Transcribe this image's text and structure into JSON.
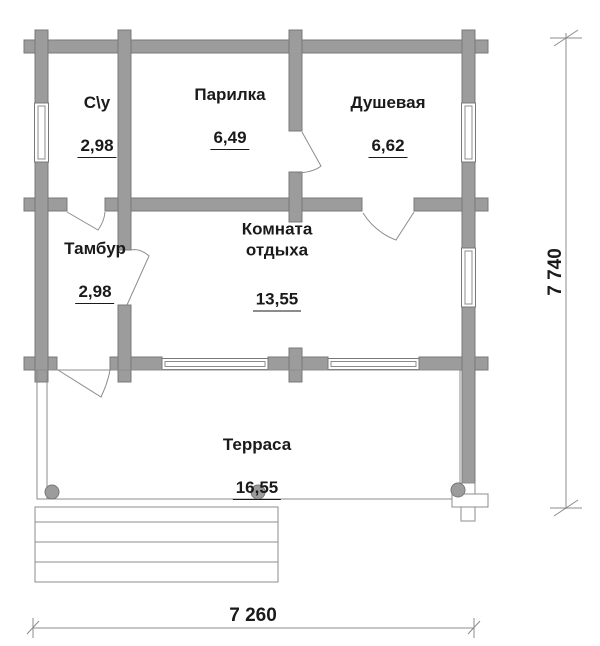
{
  "drawing_type": "floor-plan",
  "rooms": [
    {
      "id": "su",
      "name": "С\\у",
      "area": "2,98"
    },
    {
      "id": "parilka",
      "name": "Парилка",
      "area": "6,49"
    },
    {
      "id": "dushevaya",
      "name": "Душевая",
      "area": "6,62"
    },
    {
      "id": "tambur",
      "name": "Тамбур",
      "area": "2,98"
    },
    {
      "id": "komnata",
      "name": "Комната отдыха",
      "area": "13,55"
    },
    {
      "id": "terrasa",
      "name": "Терраса",
      "area": "16,55"
    }
  ],
  "dimensions": {
    "overall_width_mm": "7 260",
    "overall_depth_mm": "7 740"
  },
  "colors": {
    "wall_fill": "#9c9c9c",
    "wall_stroke": "#787878",
    "line": "#8c8c8c",
    "text": "#1a1a1a",
    "background": "#ffffff"
  }
}
